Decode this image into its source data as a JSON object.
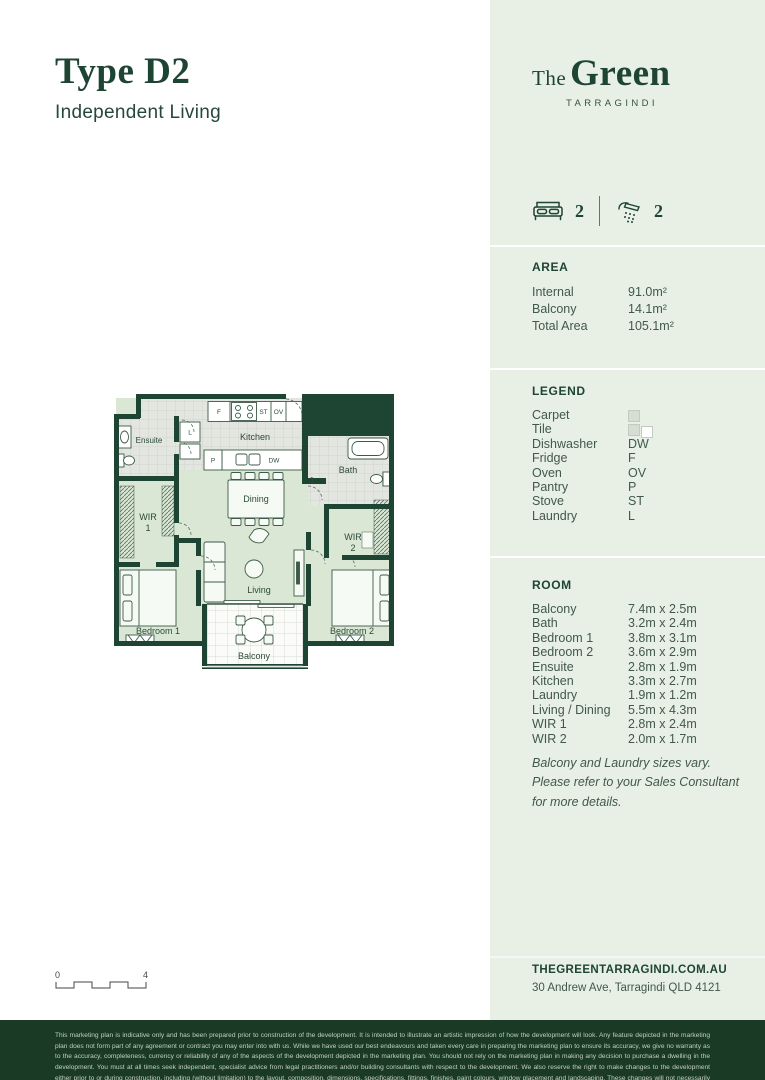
{
  "page": {
    "title": "Type D2",
    "subtitle": "Independent Living"
  },
  "brand": {
    "prefix": "The",
    "name": "Green",
    "location": "TARRAGINDI"
  },
  "stats": {
    "beds": "2",
    "baths": "2"
  },
  "area": {
    "heading": "AREA",
    "rows": [
      {
        "label": "Internal",
        "value": "91.0m²"
      },
      {
        "label": "Balcony",
        "value": "14.1m²"
      },
      {
        "label": "Total Area",
        "value": "105.1m²"
      }
    ]
  },
  "legend": {
    "heading": "LEGEND",
    "rows": [
      {
        "label": "Carpet",
        "value": ""
      },
      {
        "label": "Tile",
        "value": ""
      },
      {
        "label": "Dishwasher",
        "value": "DW"
      },
      {
        "label": "Fridge",
        "value": "F"
      },
      {
        "label": "Oven",
        "value": "OV"
      },
      {
        "label": "Pantry",
        "value": "P"
      },
      {
        "label": "Stove",
        "value": "ST"
      },
      {
        "label": "Laundry",
        "value": "L"
      }
    ]
  },
  "rooms": {
    "heading": "ROOM",
    "rows": [
      {
        "label": "Balcony",
        "value": "7.4m x 2.5m"
      },
      {
        "label": "Bath",
        "value": "3.2m x 2.4m"
      },
      {
        "label": "Bedroom 1",
        "value": "3.8m x 3.1m"
      },
      {
        "label": "Bedroom 2",
        "value": "3.6m x 2.9m"
      },
      {
        "label": "Ensuite",
        "value": "2.8m x 1.9m"
      },
      {
        "label": "Kitchen",
        "value": "3.3m x 2.7m"
      },
      {
        "label": "Laundry",
        "value": "1.9m x 1.2m"
      },
      {
        "label": "Living / Dining",
        "value": "5.5m x 4.3m"
      },
      {
        "label": "WIR 1",
        "value": "2.8m x 2.4m"
      },
      {
        "label": "WIR 2",
        "value": "2.0m x 1.7m"
      }
    ],
    "note": "Balcony and Laundry sizes vary. Please refer to your Sales Consultant for more details."
  },
  "contact": {
    "website": "THEGREENTARRAGINDI.COM.AU",
    "address": "30 Andrew Ave, Tarragindi QLD 4121"
  },
  "footer": {
    "disclaimer": "This marketing plan is indicative only and has been prepared prior to construction of the development. It is intended to illustrate an artistic impression of how the development will look. Any feature depicted in the marketing plan does not form part of any agreement or contract you may enter into with us. While we have used our best endeavours and taken every care in preparing the marketing plan to ensure its accuracy, we give no warranty as to the accuracy, completeness, currency or reliability of any of the aspects of the development depicted in the marketing plan. You should not rely on the marketing plan in making any decision to purchase a dwelling in the development. You must at all times seek independent, specialist advice from legal practitioners and/or building consultants with respect to the development. We also reserve the right to make changes to the development either prior to or during construction, including (without limitation) to the layout, composition, dimensions, specifications, fittings, finishes, paint colours, window placement and landscaping. These changes will not necessarily be reflected in the marketing plan."
  },
  "floorplan": {
    "labels": {
      "kitchen": "Kitchen",
      "dining": "Dining",
      "living": "Living",
      "balcony": "Balcony",
      "bedroom1": "Bedroom 1",
      "bedroom2": "Bedroom 2",
      "wir": "WIR",
      "wir1_num": "1",
      "wir2_num": "2",
      "bath": "Bath",
      "ensuite": "Ensuite",
      "grid_note": "1"
    },
    "appliances": {
      "fridge": "F",
      "stove": "ST",
      "oven": "OV",
      "pantry": "P",
      "dishwasher": "DW",
      "laundry": "L"
    },
    "scale": {
      "start": "0",
      "end": "4"
    }
  },
  "colors": {
    "brand_green": "#1e4434",
    "sidebar_bg": "#e8f0e6",
    "footer_bg": "#1b3a26",
    "plan_floor": "#d9e7d4",
    "plan_tile": "#e3e5e0",
    "text_green": "#41584a"
  }
}
